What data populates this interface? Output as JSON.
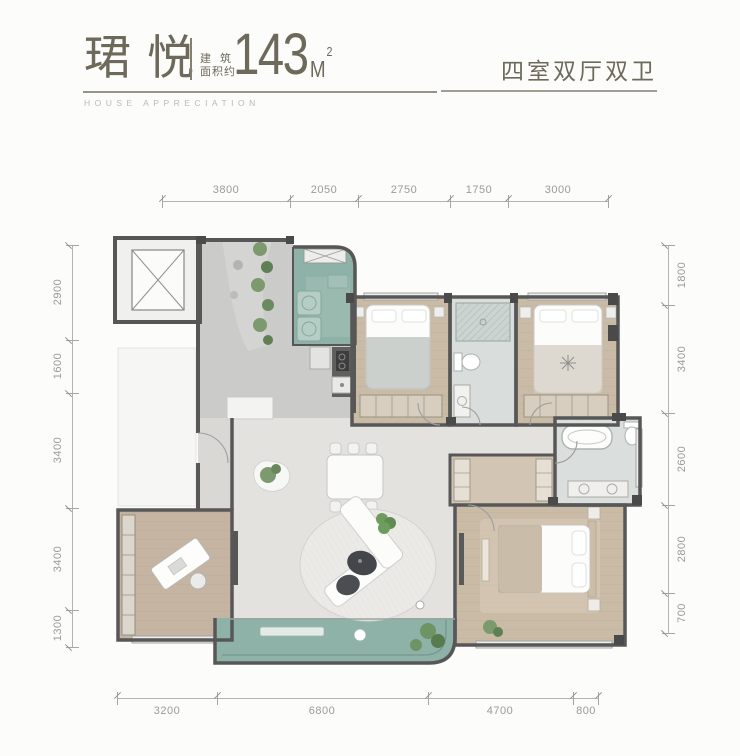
{
  "header": {
    "project_name": "珺悦",
    "area_label_line1": "建筑",
    "area_label_line2": "面积约",
    "area_number": "143",
    "area_unit": "M",
    "area_exponent": "2",
    "tagline": "HOUSE APPRECIATION",
    "layout_type": "四室双厅双卫"
  },
  "dimensions_mm": {
    "top": [
      "3800",
      "2050",
      "2750",
      "1750",
      "3000"
    ],
    "left": [
      "2900",
      "1600",
      "3400",
      "3400",
      "1300"
    ],
    "right": [
      "1800",
      "3400",
      "2600",
      "2800",
      "700"
    ],
    "bottom": [
      "3200",
      "6800",
      "4700",
      "800"
    ]
  },
  "colors": {
    "title_text": "#6e6a5b",
    "wall": "#575757",
    "wood_floor": "#cabba7",
    "stone_floor": "#e3e2df",
    "foyer_floor": "#cbcbca",
    "balcony_teal": "#8fb2a8",
    "plant_green": "#7c9a6e",
    "dimension_gray": "#9a9a98"
  }
}
